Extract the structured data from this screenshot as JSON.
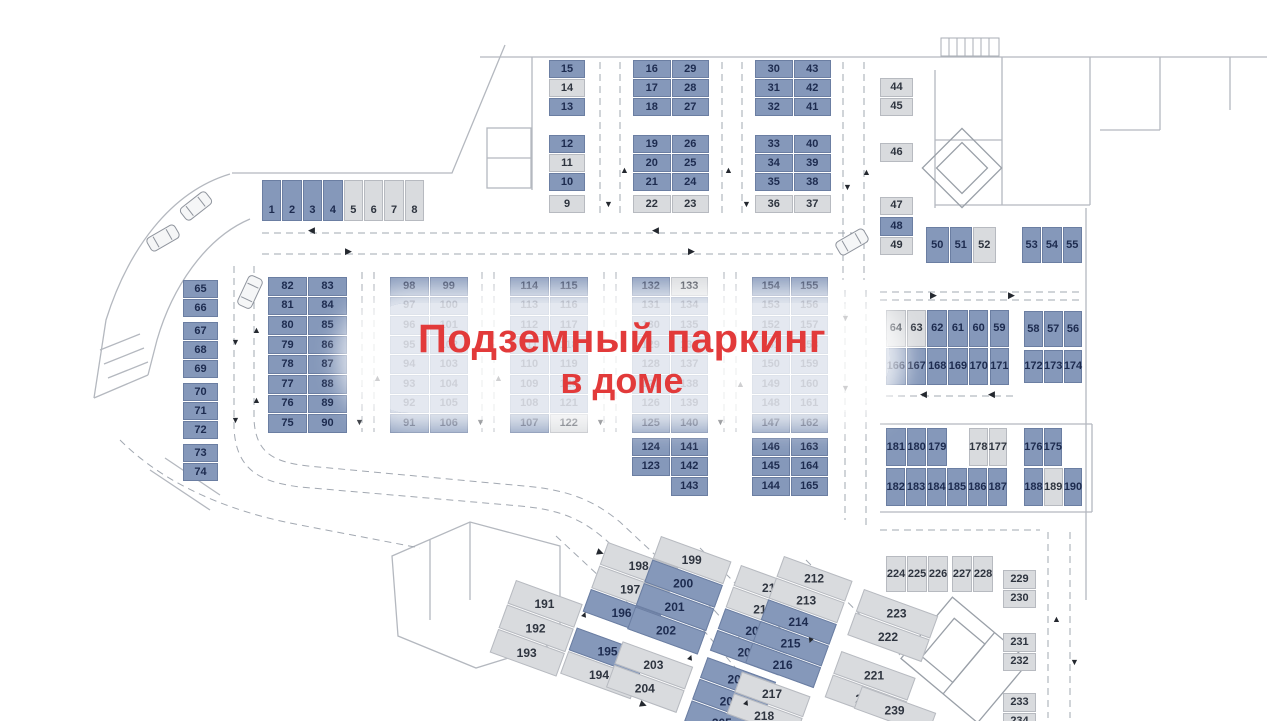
{
  "banner": {
    "line1": "Подземный паркинг",
    "line2": "в доме"
  },
  "colors": {
    "accent_red": "#e23a3a",
    "spot_blue": "#8598ba",
    "spot_blue_border": "#6b7ea2",
    "spot_gray": "#d9dbde",
    "spot_gray_border": "#b7bac0",
    "num_blue": "#1d2b4f",
    "num_gray": "#2e343f"
  },
  "groups": [
    {
      "name": "1-8",
      "x": 262,
      "y": 180,
      "cellW": 20.4,
      "cellH": 42,
      "lb": true,
      "rows": [
        [
          "1:b",
          "2:b",
          "3:b",
          "4:b",
          "5:g",
          "6:g",
          "7:g",
          "8:g"
        ]
      ]
    },
    {
      "name": "9-15",
      "x": 549,
      "y": 60,
      "cellW": 37,
      "cellH": 19,
      "rows": [
        [
          "15:b"
        ],
        [
          "14:g"
        ],
        [
          "13:b"
        ],
        {
          "gap": 18
        },
        [
          "12:b"
        ],
        [
          "11:g"
        ],
        [
          "10:b"
        ],
        {
          "gap": 3
        },
        [
          "9:g"
        ]
      ]
    },
    {
      "name": "16-29",
      "x": 633,
      "y": 60,
      "cellW": 38.5,
      "cellH": 19,
      "rows": [
        [
          "16:b",
          "29:b"
        ],
        [
          "17:b",
          "28:b"
        ],
        [
          "18:b",
          "27:b"
        ],
        {
          "gap": 18
        },
        [
          "19:b",
          "26:b"
        ],
        [
          "20:b",
          "25:b"
        ],
        [
          "21:b",
          "24:b"
        ],
        {
          "gap": 3
        },
        [
          "22:g",
          "23:g"
        ]
      ]
    },
    {
      "name": "30-43",
      "x": 755,
      "y": 60,
      "cellW": 38.5,
      "cellH": 19,
      "rows": [
        [
          "30:b",
          "43:b"
        ],
        [
          "31:b",
          "42:b"
        ],
        [
          "32:b",
          "41:b"
        ],
        {
          "gap": 18
        },
        [
          "33:b",
          "40:b"
        ],
        [
          "34:b",
          "39:b"
        ],
        [
          "35:b",
          "38:b"
        ],
        {
          "gap": 3
        },
        [
          "36:g",
          "37:g"
        ]
      ]
    },
    {
      "name": "44-49",
      "x": 880,
      "y": 78,
      "cellW": 34,
      "cellH": 19.5,
      "rows": [
        [
          "44:g"
        ],
        [
          "45:g"
        ],
        {
          "gap": 26
        },
        [
          "46:g"
        ],
        {
          "gap": 34
        },
        [
          "47:g"
        ],
        {
          "gap": 1
        },
        [
          "48:b"
        ],
        [
          "49:g"
        ]
      ]
    },
    {
      "name": "50-52",
      "x": 926,
      "y": 227,
      "cellW": 23.5,
      "cellH": 37,
      "rows": [
        [
          "50:b",
          "51:b",
          "52:g"
        ]
      ]
    },
    {
      "name": "53-55",
      "x": 1022,
      "y": 227,
      "cellW": 20.3,
      "cellH": 37,
      "rows": [
        [
          "53:b",
          "54:b",
          "55:b"
        ]
      ]
    },
    {
      "name": "56-58",
      "x": 1024,
      "y": 311,
      "cellW": 19.8,
      "cellH": 37,
      "rows": [
        [
          "58:b",
          "57:b",
          "56:b"
        ]
      ]
    },
    {
      "name": "172-174",
      "x": 1024,
      "y": 350,
      "cellW": 19.8,
      "cellH": 34,
      "rows": [
        [
          "172:b",
          "173:b",
          "174:b"
        ]
      ]
    },
    {
      "name": "59-64-166-171",
      "x": 886,
      "y": 310,
      "cellW": 20.7,
      "cellH": 38,
      "rows": [
        [
          "64:g",
          "63:g",
          "62:b",
          "61:b",
          "60:b",
          "59:b"
        ],
        [
          "166:b",
          "167:b",
          "168:b",
          "169:b",
          "170:b",
          "171:b"
        ]
      ]
    },
    {
      "name": "65-74",
      "x": 183,
      "y": 280,
      "cellW": 36,
      "cellH": 19,
      "rows": [
        [
          "65:b"
        ],
        [
          "66:b"
        ],
        {
          "gap": 4
        },
        [
          "67:b"
        ],
        [
          "68:b"
        ],
        [
          "69:b"
        ],
        {
          "gap": 4
        },
        [
          "70:b"
        ],
        [
          "71:b"
        ],
        [
          "72:b"
        ],
        {
          "gap": 4
        },
        [
          "73:b"
        ],
        [
          "74:b"
        ]
      ]
    },
    {
      "name": "75-90",
      "x": 268,
      "y": 277,
      "cellW": 40,
      "cellH": 19.6,
      "rows": [
        [
          "82:b",
          "83:b"
        ],
        [
          "81:b",
          "84:b"
        ],
        [
          "80:b",
          "85:b"
        ],
        [
          "79:b",
          "86:b"
        ],
        [
          "78:b",
          "87:b"
        ],
        [
          "77:b",
          "88:b"
        ],
        [
          "76:b",
          "89:b"
        ],
        [
          "75:b",
          "90:b"
        ]
      ]
    },
    {
      "name": "91-106",
      "x": 390,
      "y": 277,
      "cellW": 39.5,
      "cellH": 19.6,
      "rows": [
        [
          "98:b",
          "99:b"
        ],
        [
          "97:b",
          "100:b"
        ],
        [
          "96:b",
          "101:b"
        ],
        [
          "95:b",
          "102:b"
        ],
        [
          "94:b",
          "103:b"
        ],
        [
          "93:b",
          "104:b"
        ],
        [
          "92:b",
          "105:b"
        ],
        [
          "91:b",
          "106:b"
        ]
      ]
    },
    {
      "name": "107-122",
      "x": 510,
      "y": 277,
      "cellW": 39.5,
      "cellH": 19.6,
      "rows": [
        [
          "114:b",
          "115:b"
        ],
        [
          "113:b",
          "116:b"
        ],
        [
          "112:b",
          "117:b"
        ],
        [
          "111:b",
          "118:b"
        ],
        [
          "110:b",
          "119:b"
        ],
        [
          "109:b",
          "120:b"
        ],
        [
          "108:b",
          "121:b"
        ],
        [
          "107:b",
          "122:g"
        ]
      ]
    },
    {
      "name": "123-143",
      "x": 632,
      "y": 277,
      "cellW": 38.5,
      "cellH": 19.6,
      "rows": [
        [
          "132:b",
          "133:g"
        ],
        [
          "131:b",
          "134:b"
        ],
        [
          "130:b",
          "135:b"
        ],
        [
          "129:b",
          "136:b"
        ],
        [
          "128:b",
          "137:b"
        ],
        [
          "127:b",
          "138:b"
        ],
        [
          "126:b",
          "139:b"
        ],
        [
          "125:b",
          "140:b"
        ],
        {
          "gap": 4
        },
        [
          "124:b",
          "141:b"
        ],
        [
          "123:b",
          "142:b"
        ],
        [
          "",
          "143:b"
        ]
      ]
    },
    {
      "name": "144-165",
      "x": 752,
      "y": 277,
      "cellW": 38.5,
      "cellH": 19.6,
      "rows": [
        [
          "154:b",
          "155:b"
        ],
        [
          "153:b",
          "156:b"
        ],
        [
          "152:b",
          "157:b"
        ],
        [
          "151:b",
          "158:b"
        ],
        [
          "150:b",
          "159:b"
        ],
        [
          "149:b",
          "160:b"
        ],
        [
          "148:b",
          "161:b"
        ],
        [
          "147:b",
          "162:b"
        ],
        {
          "gap": 4
        },
        [
          "146:b",
          "163:b"
        ],
        [
          "145:b",
          "164:b"
        ],
        [
          "144:b",
          "165:b"
        ]
      ]
    },
    {
      "name": "179-181",
      "x": 886,
      "y": 428,
      "cellW": 20.7,
      "cellH": 39,
      "rows": [
        [
          "181:b",
          "180:b",
          "179:b"
        ]
      ]
    },
    {
      "name": "177-178",
      "x": 969,
      "y": 428,
      "cellW": 19.5,
      "cellH": 39,
      "rows": [
        [
          "178:g",
          "177:g"
        ]
      ]
    },
    {
      "name": "175-176",
      "x": 1024,
      "y": 428,
      "cellW": 19.5,
      "cellH": 39,
      "rows": [
        [
          "176:b",
          "175:b"
        ]
      ]
    },
    {
      "name": "182-187",
      "x": 886,
      "y": 468,
      "cellW": 20.4,
      "cellH": 39,
      "rows": [
        [
          "182:b",
          "183:b",
          "184:b",
          "185:b",
          "186:b",
          "187:b"
        ]
      ]
    },
    {
      "name": "188-190",
      "x": 1024,
      "y": 468,
      "cellW": 19.8,
      "cellH": 39,
      "rows": [
        [
          "188:b",
          "189:g",
          "190:b"
        ]
      ]
    },
    {
      "name": "191-193",
      "x": 516,
      "y": 580,
      "rot": 20,
      "cellW": 72,
      "cellH": 26,
      "rows": [
        [
          "191:g"
        ],
        [
          "192:g"
        ],
        [
          "193:g"
        ]
      ]
    },
    {
      "name": "194-198",
      "x": 608,
      "y": 542,
      "rot": 20,
      "cellW": 76,
      "cellH": 25,
      "rows": [
        [
          "198:g"
        ],
        [
          "197:g"
        ],
        [
          "196:b"
        ],
        {
          "gap": 16
        },
        [
          "195:b"
        ],
        [
          "194:g"
        ]
      ]
    },
    {
      "name": "199-204",
      "x": 661,
      "y": 536,
      "rot": 20,
      "cellW": 76,
      "cellH": 25,
      "rows": [
        [
          "199:g"
        ],
        [
          "200:b"
        ],
        [
          "201:b"
        ],
        [
          "202:b"
        ],
        {
          "gap": 12
        },
        [
          "203:g"
        ],
        [
          "204:g"
        ]
      ]
    },
    {
      "name": "205-211",
      "x": 741,
      "y": 565,
      "rot": 20,
      "cellW": 74,
      "cellH": 23,
      "rows": [
        [
          "211:g"
        ],
        [
          "210:g"
        ],
        [
          "209:b"
        ],
        [
          "208:b"
        ],
        {
          "gap": 6
        },
        [
          "207:b"
        ],
        [
          "206:b"
        ],
        [
          "205:b"
        ]
      ]
    },
    {
      "name": "212-218",
      "x": 784,
      "y": 556,
      "rot": 20,
      "cellW": 74,
      "cellH": 23,
      "rows": [
        [
          "212:g"
        ],
        [
          "213:g"
        ],
        [
          "214:b"
        ],
        [
          "215:b"
        ],
        [
          "216:b"
        ],
        {
          "gap": 8
        },
        [
          "217:g"
        ],
        [
          "218:g"
        ]
      ]
    },
    {
      "name": "220-223",
      "x": 864,
      "y": 589,
      "rot": 20,
      "cellW": 80,
      "cellH": 25,
      "rows": [
        [
          "223:g"
        ],
        [
          "222:g"
        ],
        {
          "gap": 16
        },
        [
          "221:g"
        ],
        [
          "220:g"
        ]
      ]
    },
    {
      "name": "239",
      "x": 862,
      "y": 686,
      "rot": 20,
      "cellW": 80,
      "cellH": 25,
      "rows": [
        [
          "239:g"
        ]
      ]
    },
    {
      "name": "224-226",
      "x": 886,
      "y": 556,
      "cellW": 21,
      "cellH": 37,
      "rows": [
        [
          "224:g",
          "225:g",
          "226:g"
        ]
      ]
    },
    {
      "name": "227-228",
      "x": 952,
      "y": 556,
      "cellW": 21,
      "cellH": 37,
      "rows": [
        [
          "227:g",
          "228:g"
        ]
      ]
    },
    {
      "name": "229-234",
      "x": 1003,
      "y": 570,
      "cellW": 34,
      "cellH": 19.5,
      "rows": [
        [
          "229:g"
        ],
        [
          "230:g"
        ],
        {
          "gap": 24
        },
        [
          "231:g"
        ],
        [
          "232:g"
        ],
        {
          "gap": 21
        },
        [
          "233:g"
        ],
        [
          "234:g"
        ]
      ]
    }
  ],
  "arrows": [
    {
      "x": 308,
      "y": 226,
      "g": "◀"
    },
    {
      "x": 652,
      "y": 226,
      "g": "◀"
    },
    {
      "x": 345,
      "y": 247,
      "g": "▶"
    },
    {
      "x": 688,
      "y": 247,
      "g": "▶"
    },
    {
      "x": 604,
      "y": 200,
      "g": "▼"
    },
    {
      "x": 620,
      "y": 166,
      "g": "▲"
    },
    {
      "x": 724,
      "y": 166,
      "g": "▲"
    },
    {
      "x": 742,
      "y": 200,
      "g": "▼"
    },
    {
      "x": 843,
      "y": 183,
      "g": "▼"
    },
    {
      "x": 862,
      "y": 168,
      "g": "▲"
    },
    {
      "x": 231,
      "y": 338,
      "g": "▼"
    },
    {
      "x": 252,
      "y": 326,
      "g": "▲"
    },
    {
      "x": 231,
      "y": 416,
      "g": "▼"
    },
    {
      "x": 252,
      "y": 396,
      "g": "▲"
    },
    {
      "x": 355,
      "y": 418,
      "g": "▼"
    },
    {
      "x": 373,
      "y": 374,
      "g": "▲"
    },
    {
      "x": 476,
      "y": 418,
      "g": "▼"
    },
    {
      "x": 494,
      "y": 374,
      "g": "▲"
    },
    {
      "x": 596,
      "y": 418,
      "g": "▼"
    },
    {
      "x": 716,
      "y": 418,
      "g": "▼"
    },
    {
      "x": 736,
      "y": 380,
      "g": "▲"
    },
    {
      "x": 841,
      "y": 314,
      "g": "▼"
    },
    {
      "x": 841,
      "y": 384,
      "g": "▼"
    },
    {
      "x": 930,
      "y": 291,
      "g": "▶"
    },
    {
      "x": 1008,
      "y": 291,
      "g": "▶"
    },
    {
      "x": 920,
      "y": 390,
      "g": "◀"
    },
    {
      "x": 988,
      "y": 390,
      "g": "◀"
    },
    {
      "x": 597,
      "y": 548,
      "g": "▶",
      "r": 20
    },
    {
      "x": 580,
      "y": 610,
      "g": "▲",
      "r": 20
    },
    {
      "x": 686,
      "y": 653,
      "g": "▲",
      "r": 20
    },
    {
      "x": 742,
      "y": 698,
      "g": "▲",
      "r": 20
    },
    {
      "x": 806,
      "y": 636,
      "g": "▼",
      "r": 20
    },
    {
      "x": 640,
      "y": 700,
      "g": "▶",
      "r": 20
    },
    {
      "x": 1052,
      "y": 615,
      "g": "▲"
    },
    {
      "x": 1070,
      "y": 658,
      "g": "▼"
    }
  ]
}
